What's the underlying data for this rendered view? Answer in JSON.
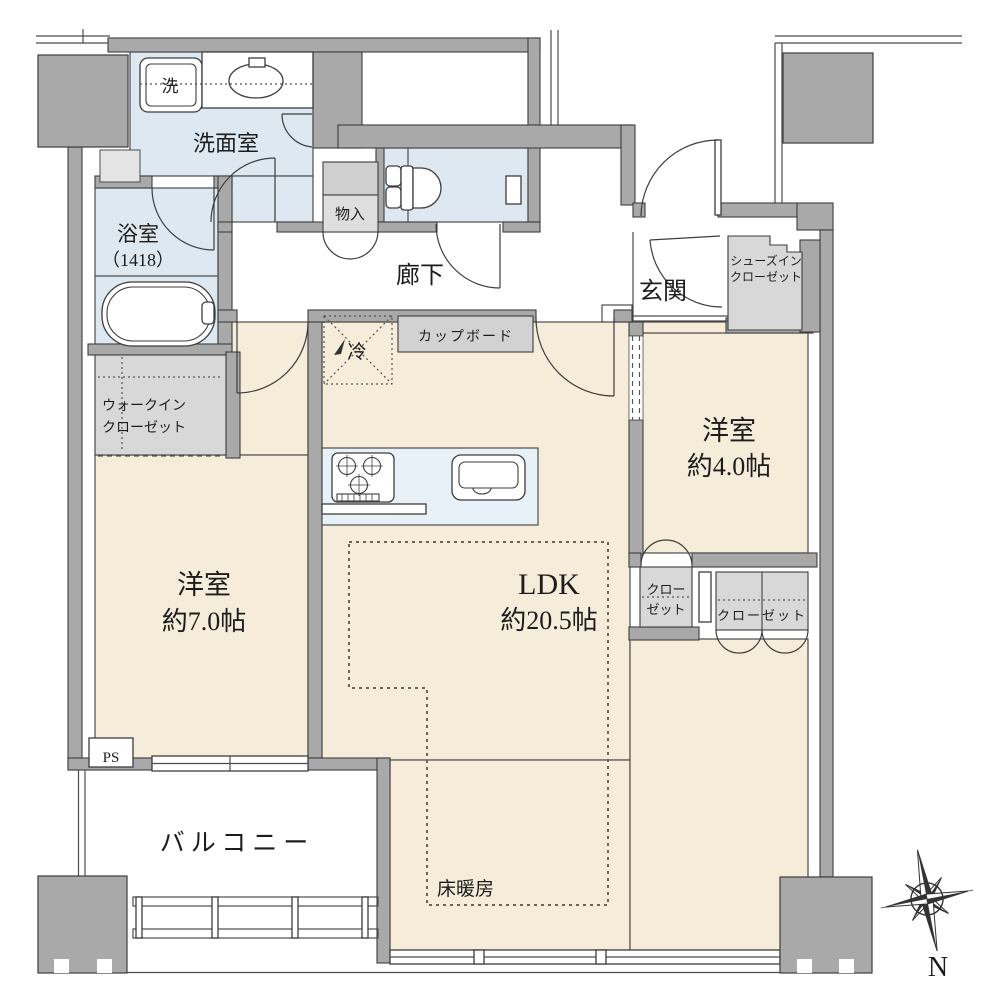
{
  "colors": {
    "wall_gray": "#a9a9a9",
    "room_beige": "#f5ecda",
    "wet_blue": "#dde8f1",
    "counter_blue": "#e9f1f8",
    "closet_gray": "#d8d8d8",
    "cupboard_gray": "#d2d2d2",
    "line_dark": "#3d3d3d",
    "text_dark": "#1c1c1c"
  },
  "labels": {
    "washer": "洗",
    "washroom": "洗面室",
    "bath_line1": "浴室",
    "bath_line2": "（1418）",
    "storage": "物入",
    "hallway": "廊下",
    "entrance": "玄関",
    "sic_line1": "シューズイン",
    "sic_line2": "クローゼット",
    "wic_line1": "ウォークイン",
    "wic_line2": "クローゼット",
    "bedroom_west_line1": "洋室",
    "bedroom_west_line2": "約7.0帖",
    "ldk_line1": "LDK",
    "ldk_line2": "約20.5帖",
    "bedroom_east_line1": "洋室",
    "bedroom_east_line2": "約4.0帖",
    "closet_small_line1": "クロー",
    "closet_small_line2": "ゼット",
    "closet_wide": "クローゼット",
    "cupboard": "カップボード",
    "fridge": "冷",
    "floor_heating": "床暖房",
    "balcony": "バルコニー",
    "pipe_space": "PS",
    "compass_north": "N"
  },
  "rooms": [
    {
      "name": "洋室",
      "size": "約7.0帖"
    },
    {
      "name": "LDK",
      "size": "約20.5帖"
    },
    {
      "name": "洋室",
      "size": "約4.0帖"
    },
    {
      "name": "浴室",
      "size": "1418"
    },
    {
      "name": "洗面室",
      "size": ""
    },
    {
      "name": "廊下",
      "size": ""
    },
    {
      "name": "玄関",
      "size": ""
    },
    {
      "name": "バルコニー",
      "size": ""
    }
  ]
}
